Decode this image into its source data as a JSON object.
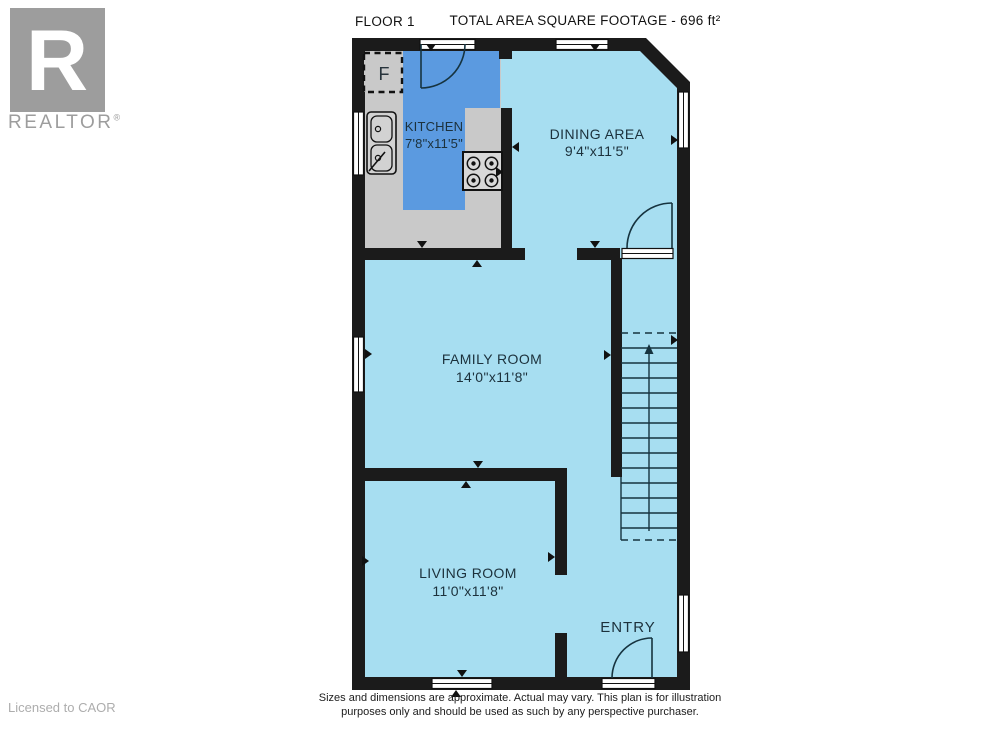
{
  "header": {
    "floor_label": "FLOOR 1",
    "total_area": "TOTAL AREA SQUARE FOOTAGE - 696 ft²"
  },
  "branding": {
    "logo_letter": "R",
    "wordmark": "REALTOR",
    "registered": "®",
    "license": "Licensed to CAOR"
  },
  "rooms": {
    "kitchen": {
      "name": "KITCHEN",
      "dimensions": "7'8\"x11'5\""
    },
    "dining": {
      "name": "DINING AREA",
      "dimensions": "9'4\"x11'5\""
    },
    "family": {
      "name": "FAMILY ROOM",
      "dimensions": "14'0\"x11'8\""
    },
    "living": {
      "name": "LIVING ROOM",
      "dimensions": "11'0\"x11'8\""
    },
    "entry": {
      "name": "ENTRY"
    },
    "fridge_label": "F"
  },
  "footer": {
    "disclaimer_line1": "Sizes and dimensions are approximate. Actual may vary. This plan is for illustration",
    "disclaimer_line2": "purposes only and should be used as such by any perspective purchaser."
  },
  "colors": {
    "wall": "#1b1b1b",
    "floor": "#a7def1",
    "kitchen_floor": "#c9c9c9",
    "kitchen_highlight": "#5b9ae0",
    "fixture_line": "#16333f",
    "label_text": "#1c313c",
    "logo_grey": "#9d9d9d"
  }
}
